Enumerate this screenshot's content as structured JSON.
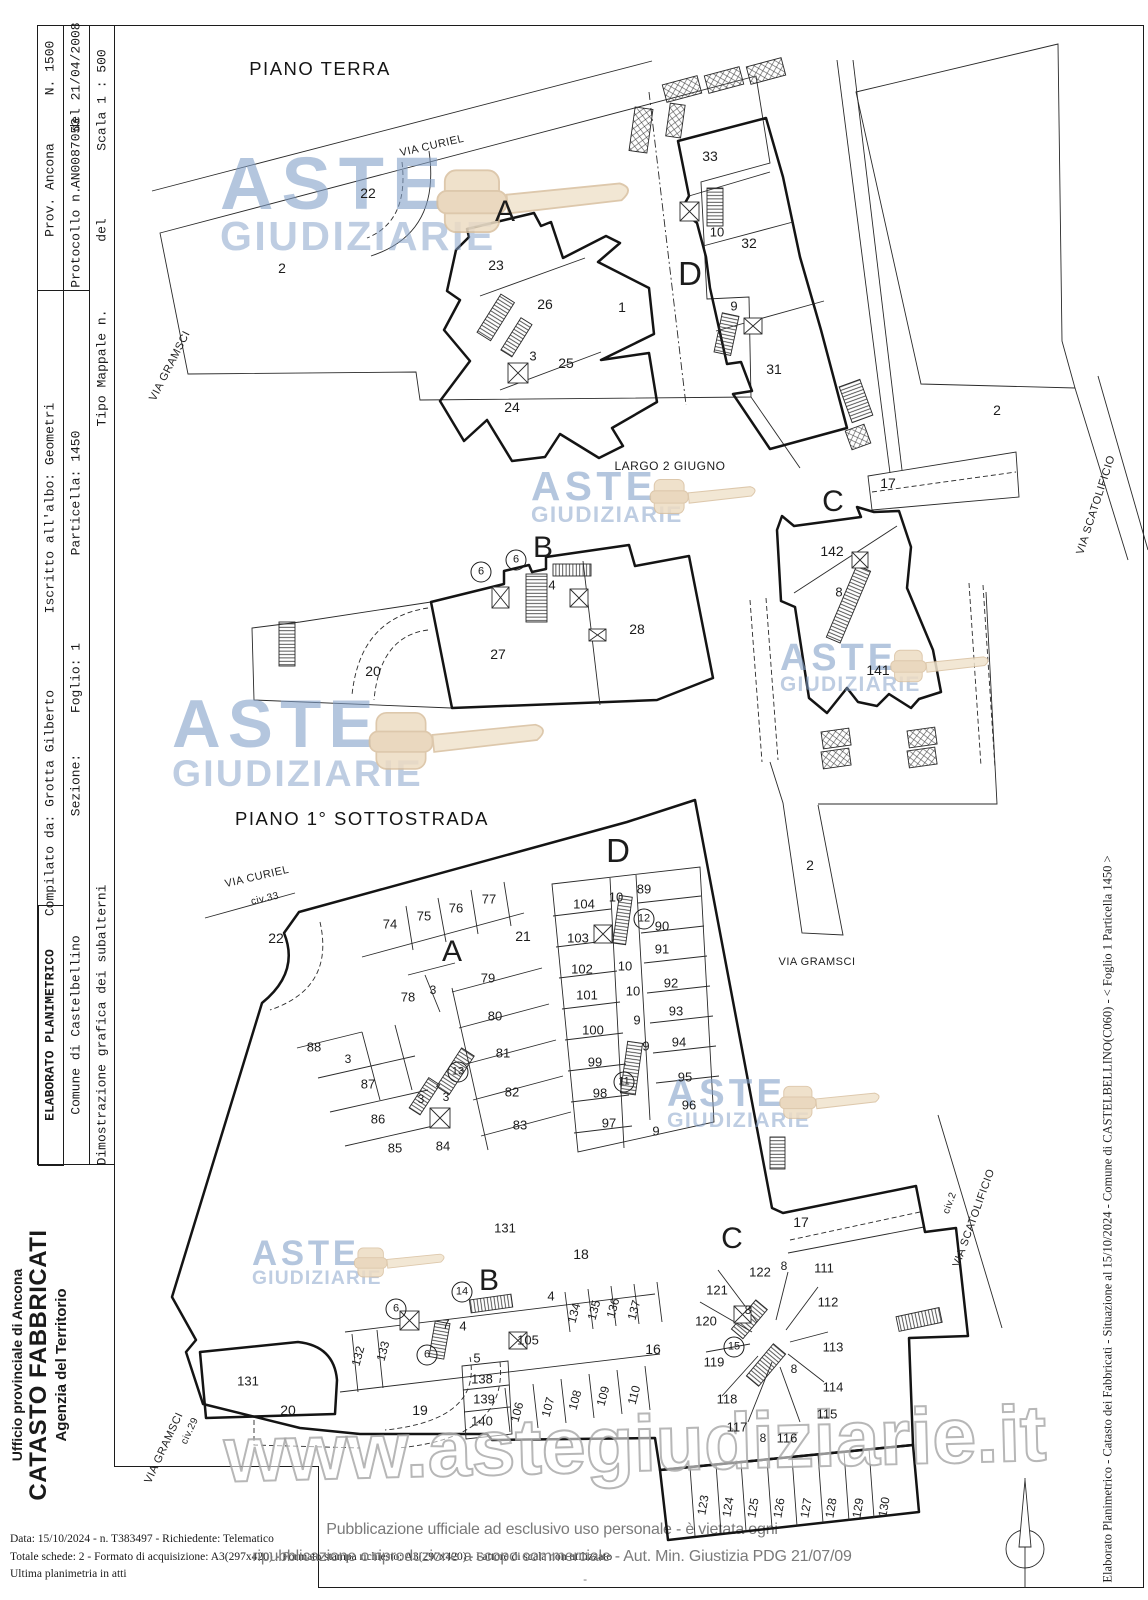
{
  "header": {
    "elaborato": "ELABORATO PLANIMETRICO",
    "comune": "Comune di Castelbellino",
    "dimostrazione": "Dimostrazione grafica dei subalterni",
    "compilato": "Compilato da: Grotta Gilberto",
    "sezione": "Sezione:",
    "foglio": "Foglio: 1",
    "iscritto": "Iscritto all'albo: Geometri",
    "particella": "Particella: 1450",
    "prov": "Prov. Ancona",
    "numero": "N. 1500",
    "protocollo_label": "Protocollo n.",
    "protocollo_num": "AN0087053",
    "protocollo_del": "del 21/04/2008",
    "tipo_mappale": "Tipo Mappale n.",
    "tipo_del": "del",
    "scala": "Scala 1 : 500"
  },
  "agency": {
    "line1": "Ufficio provinciale di  Ancona",
    "line2": "CATASTO FABBRICATI",
    "line3": "Agenzia del Territorio"
  },
  "footer": {
    "line1": "Data: 15/10/2024 - n. T383497 - Richiedente: Telematico",
    "line2": "Totale schede: 2 - Formato di acquisizione: A3(297x420) - Formato stampa richiesto: A3(297x420) - Fattore di scala non utilizzato",
    "line3": "Ultima planimetria in atti"
  },
  "publication": {
    "line1": "Pubblicazione ufficiale ad esclusivo uso personale - è vietata ogni",
    "line2": "ripubblicazione o riproduzione a scopo commerciale - Aut. Min. Giustizia PDG 21/07/09",
    "dash": "-"
  },
  "right_margin": "Elaborato Planimetrico - Catasto dei Fabbricati - Situazione al 15/10/2024 - Comune di CASTELBELLINO(C060) - < Foglio 1 Particella 1450 >",
  "watermarks": {
    "word1": "ASTE",
    "word2": "GIUDIZIARIE",
    "url": "www.astegiudiziarie.it",
    "instances": [
      {
        "x": 220,
        "y": 150,
        "s": 1.0
      },
      {
        "x": 531,
        "y": 468,
        "s": 0.55
      },
      {
        "x": 780,
        "y": 640,
        "s": 0.51
      },
      {
        "x": 172,
        "y": 694,
        "s": 0.91
      },
      {
        "x": 667,
        "y": 1076,
        "s": 0.52
      },
      {
        "x": 252,
        "y": 1238,
        "s": 0.47
      }
    ]
  },
  "plans": {
    "terra": {
      "title": "PIANO TERRA",
      "title_x": 320,
      "title_y": 69,
      "labels": [
        {
          "t": "VIA CURIEL",
          "x": 432,
          "y": 146,
          "r": -13,
          "cls": "street"
        },
        {
          "t": "VIA GRAMSCI",
          "x": 170,
          "y": 366,
          "r": -63,
          "cls": "street"
        },
        {
          "t": "22",
          "x": 368,
          "y": 193,
          "fs": 14
        },
        {
          "t": "A",
          "x": 505,
          "y": 212,
          "cls": "big"
        },
        {
          "t": "2",
          "x": 282,
          "y": 268,
          "fs": 14
        },
        {
          "t": "23",
          "x": 496,
          "y": 265,
          "fs": 14
        },
        {
          "t": "26",
          "x": 545,
          "y": 304,
          "fs": 14
        },
        {
          "t": "3",
          "x": 533,
          "y": 356,
          "fs": 13
        },
        {
          "t": "25",
          "x": 566,
          "y": 363,
          "fs": 14
        },
        {
          "t": "24",
          "x": 512,
          "y": 407,
          "fs": 14
        },
        {
          "t": "1",
          "x": 622,
          "y": 307,
          "fs": 14
        },
        {
          "t": "33",
          "x": 710,
          "y": 156,
          "fs": 14
        },
        {
          "t": "10",
          "x": 717,
          "y": 232,
          "fs": 13
        },
        {
          "t": "32",
          "x": 749,
          "y": 243,
          "fs": 14
        },
        {
          "t": "D",
          "x": 690,
          "y": 274,
          "cls": "big",
          "fs": 33
        },
        {
          "t": "9",
          "x": 734,
          "y": 306,
          "fs": 13
        },
        {
          "t": "31",
          "x": 774,
          "y": 369,
          "fs": 14
        },
        {
          "t": "2",
          "x": 997,
          "y": 410,
          "fs": 14
        },
        {
          "t": "17",
          "x": 888,
          "y": 483,
          "fs": 14
        },
        {
          "t": "VIA SCATOLIFICIO",
          "x": 1096,
          "y": 505,
          "r": -72,
          "cls": "street"
        },
        {
          "t": "LARGO 2 GIUGNO",
          "x": 670,
          "y": 466,
          "cls": "street2"
        },
        {
          "t": "C",
          "x": 833,
          "y": 502,
          "cls": "big"
        },
        {
          "t": "142",
          "x": 832,
          "y": 551,
          "fs": 14
        },
        {
          "t": "8",
          "x": 839,
          "y": 592,
          "fs": 13
        },
        {
          "t": "141",
          "x": 878,
          "y": 670,
          "fs": 14
        },
        {
          "t": "B",
          "x": 543,
          "y": 548,
          "cls": "big"
        },
        {
          "t": "6",
          "x": 481,
          "y": 572,
          "fs": 11,
          "circ": true
        },
        {
          "t": "6",
          "x": 516,
          "y": 560,
          "fs": 11,
          "circ": true
        },
        {
          "t": "4",
          "x": 552,
          "y": 585,
          "fs": 13
        },
        {
          "t": "28",
          "x": 637,
          "y": 629,
          "fs": 14
        },
        {
          "t": "27",
          "x": 498,
          "y": 654,
          "fs": 14
        },
        {
          "t": "20",
          "x": 373,
          "y": 671,
          "fs": 14
        }
      ]
    },
    "sottostrada": {
      "title": "PIANO 1° SOTTOSTRADA",
      "title_x": 362,
      "title_y": 819,
      "labels": [
        {
          "t": "VIA CURIEL",
          "x": 257,
          "y": 877,
          "r": -13,
          "cls": "street"
        },
        {
          "t": "civ.33",
          "x": 265,
          "y": 899,
          "r": -13,
          "fs": 10,
          "cls": "street"
        },
        {
          "t": "22",
          "x": 276,
          "y": 938,
          "fs": 14
        },
        {
          "t": "74",
          "x": 390,
          "y": 924
        },
        {
          "t": "75",
          "x": 424,
          "y": 916
        },
        {
          "t": "76",
          "x": 456,
          "y": 908
        },
        {
          "t": "77",
          "x": 489,
          "y": 899
        },
        {
          "t": "21",
          "x": 523,
          "y": 936,
          "fs": 14
        },
        {
          "t": "A",
          "x": 452,
          "y": 952,
          "cls": "big"
        },
        {
          "t": "D",
          "x": 618,
          "y": 851,
          "cls": "big",
          "fs": 33
        },
        {
          "t": "104",
          "x": 584,
          "y": 904
        },
        {
          "t": "10",
          "x": 616,
          "y": 897
        },
        {
          "t": "89",
          "x": 644,
          "y": 889
        },
        {
          "t": "12",
          "x": 644,
          "y": 919,
          "fs": 11,
          "circ": true
        },
        {
          "t": "90",
          "x": 662,
          "y": 926
        },
        {
          "t": "103",
          "x": 578,
          "y": 938
        },
        {
          "t": "91",
          "x": 662,
          "y": 949
        },
        {
          "t": "102",
          "x": 582,
          "y": 969
        },
        {
          "t": "10",
          "x": 625,
          "y": 966
        },
        {
          "t": "10",
          "x": 633,
          "y": 991
        },
        {
          "t": "92",
          "x": 671,
          "y": 983
        },
        {
          "t": "101",
          "x": 587,
          "y": 995
        },
        {
          "t": "93",
          "x": 676,
          "y": 1011
        },
        {
          "t": "9",
          "x": 637,
          "y": 1020
        },
        {
          "t": "100",
          "x": 593,
          "y": 1030
        },
        {
          "t": "9",
          "x": 646,
          "y": 1046
        },
        {
          "t": "94",
          "x": 679,
          "y": 1042
        },
        {
          "t": "99",
          "x": 595,
          "y": 1062
        },
        {
          "t": "95",
          "x": 685,
          "y": 1077
        },
        {
          "t": "11",
          "x": 624,
          "y": 1082,
          "fs": 11,
          "circ": true
        },
        {
          "t": "98",
          "x": 600,
          "y": 1093
        },
        {
          "t": "96",
          "x": 689,
          "y": 1105
        },
        {
          "t": "97",
          "x": 609,
          "y": 1123
        },
        {
          "t": "9",
          "x": 656,
          "y": 1131
        },
        {
          "t": "2",
          "x": 810,
          "y": 865,
          "fs": 14
        },
        {
          "t": "VIA GRAMSCI",
          "x": 817,
          "y": 962,
          "cls": "street"
        },
        {
          "t": "79",
          "x": 488,
          "y": 978
        },
        {
          "t": "78",
          "x": 408,
          "y": 997
        },
        {
          "t": "3",
          "x": 433,
          "y": 990,
          "fs": 12
        },
        {
          "t": "80",
          "x": 495,
          "y": 1016
        },
        {
          "t": "81",
          "x": 503,
          "y": 1053
        },
        {
          "t": "13",
          "x": 458,
          "y": 1072,
          "fs": 11,
          "circ": true
        },
        {
          "t": "82",
          "x": 512,
          "y": 1092
        },
        {
          "t": "83",
          "x": 520,
          "y": 1125
        },
        {
          "t": "88",
          "x": 314,
          "y": 1047
        },
        {
          "t": "3",
          "x": 348,
          "y": 1059,
          "fs": 12
        },
        {
          "t": "87",
          "x": 368,
          "y": 1084
        },
        {
          "t": "3",
          "x": 421,
          "y": 1099,
          "fs": 12
        },
        {
          "t": "3",
          "x": 446,
          "y": 1097,
          "fs": 12
        },
        {
          "t": "86",
          "x": 378,
          "y": 1119
        },
        {
          "t": "85",
          "x": 395,
          "y": 1148
        },
        {
          "t": "84",
          "x": 443,
          "y": 1146
        },
        {
          "t": "131",
          "x": 505,
          "y": 1228
        },
        {
          "t": "18",
          "x": 581,
          "y": 1254,
          "fs": 14
        },
        {
          "t": "B",
          "x": 489,
          "y": 1281,
          "cls": "big"
        },
        {
          "t": "14",
          "x": 462,
          "y": 1292,
          "fs": 11,
          "circ": true
        },
        {
          "t": "4",
          "x": 551,
          "y": 1296
        },
        {
          "t": "6",
          "x": 396,
          "y": 1309,
          "fs": 11,
          "circ": true
        },
        {
          "t": "7",
          "x": 446,
          "y": 1324
        },
        {
          "t": "4",
          "x": 463,
          "y": 1326
        },
        {
          "t": "134",
          "x": 574,
          "y": 1313,
          "fs": 12,
          "r": -75
        },
        {
          "t": "135",
          "x": 594,
          "y": 1310,
          "fs": 12,
          "r": -75
        },
        {
          "t": "136",
          "x": 613,
          "y": 1308,
          "fs": 12,
          "r": -75
        },
        {
          "t": "137",
          "x": 634,
          "y": 1310,
          "fs": 12,
          "r": -75
        },
        {
          "t": "105",
          "x": 528,
          "y": 1340
        },
        {
          "t": "16",
          "x": 653,
          "y": 1349,
          "fs": 14
        },
        {
          "t": "132",
          "x": 358,
          "y": 1356,
          "fs": 12,
          "r": -75
        },
        {
          "t": "133",
          "x": 383,
          "y": 1351,
          "fs": 12,
          "r": -75
        },
        {
          "t": "6",
          "x": 427,
          "y": 1355,
          "fs": 11,
          "circ": true
        },
        {
          "t": "5",
          "x": 477,
          "y": 1358
        },
        {
          "t": "131",
          "x": 248,
          "y": 1381
        },
        {
          "t": "138",
          "x": 482,
          "y": 1379
        },
        {
          "t": "139",
          "x": 484,
          "y": 1399
        },
        {
          "t": "140",
          "x": 482,
          "y": 1421
        },
        {
          "t": "106",
          "x": 517,
          "y": 1412,
          "fs": 12,
          "r": -75
        },
        {
          "t": "107",
          "x": 548,
          "y": 1407,
          "fs": 12,
          "r": -75
        },
        {
          "t": "108",
          "x": 575,
          "y": 1400,
          "fs": 12,
          "r": -75
        },
        {
          "t": "109",
          "x": 603,
          "y": 1396,
          "fs": 12,
          "r": -75
        },
        {
          "t": "110",
          "x": 634,
          "y": 1395,
          "fs": 12,
          "r": -75
        },
        {
          "t": "20",
          "x": 288,
          "y": 1410,
          "fs": 14
        },
        {
          "t": "19",
          "x": 420,
          "y": 1410,
          "fs": 14
        },
        {
          "t": "civ.29",
          "x": 190,
          "y": 1431,
          "fs": 10,
          "r": -65,
          "cls": "street"
        },
        {
          "t": "VIA GRAMSCI",
          "x": 164,
          "y": 1448,
          "r": -65,
          "cls": "street"
        },
        {
          "t": "17",
          "x": 801,
          "y": 1222,
          "fs": 14
        },
        {
          "t": "C",
          "x": 732,
          "y": 1239,
          "cls": "big"
        },
        {
          "t": "civ.2",
          "x": 950,
          "y": 1203,
          "fs": 10,
          "r": -70,
          "cls": "street"
        },
        {
          "t": "VIA SCATOLIFICIO",
          "x": 974,
          "y": 1218,
          "r": -70,
          "cls": "street"
        },
        {
          "t": "122",
          "x": 760,
          "y": 1272
        },
        {
          "t": "8",
          "x": 784,
          "y": 1266,
          "fs": 12
        },
        {
          "t": "111",
          "x": 824,
          "y": 1268
        },
        {
          "t": "121",
          "x": 717,
          "y": 1290
        },
        {
          "t": "112",
          "x": 828,
          "y": 1302
        },
        {
          "t": "8",
          "x": 748,
          "y": 1310,
          "fs": 12
        },
        {
          "t": "120",
          "x": 706,
          "y": 1321
        },
        {
          "t": "15",
          "x": 734,
          "y": 1347,
          "fs": 11,
          "circ": true
        },
        {
          "t": "113",
          "x": 833,
          "y": 1347
        },
        {
          "t": "119",
          "x": 714,
          "y": 1362
        },
        {
          "t": "8",
          "x": 794,
          "y": 1369,
          "fs": 12
        },
        {
          "t": "114",
          "x": 833,
          "y": 1387
        },
        {
          "t": "118",
          "x": 727,
          "y": 1399
        },
        {
          "t": "115",
          "x": 827,
          "y": 1414
        },
        {
          "t": "117",
          "x": 737,
          "y": 1427
        },
        {
          "t": "8",
          "x": 763,
          "y": 1438,
          "fs": 12
        },
        {
          "t": "116",
          "x": 787,
          "y": 1438
        },
        {
          "t": "123",
          "x": 703,
          "y": 1505,
          "fs": 12,
          "r": -80
        },
        {
          "t": "124",
          "x": 728,
          "y": 1507,
          "fs": 12,
          "r": -80
        },
        {
          "t": "125",
          "x": 753,
          "y": 1508,
          "fs": 12,
          "r": -80
        },
        {
          "t": "126",
          "x": 779,
          "y": 1508,
          "fs": 12,
          "r": -80
        },
        {
          "t": "127",
          "x": 806,
          "y": 1508,
          "fs": 12,
          "r": -80
        },
        {
          "t": "128",
          "x": 831,
          "y": 1508,
          "fs": 12,
          "r": -80
        },
        {
          "t": "129",
          "x": 858,
          "y": 1508,
          "fs": 12,
          "r": -80
        },
        {
          "t": "130",
          "x": 884,
          "y": 1507,
          "fs": 12,
          "r": -80
        }
      ]
    }
  }
}
